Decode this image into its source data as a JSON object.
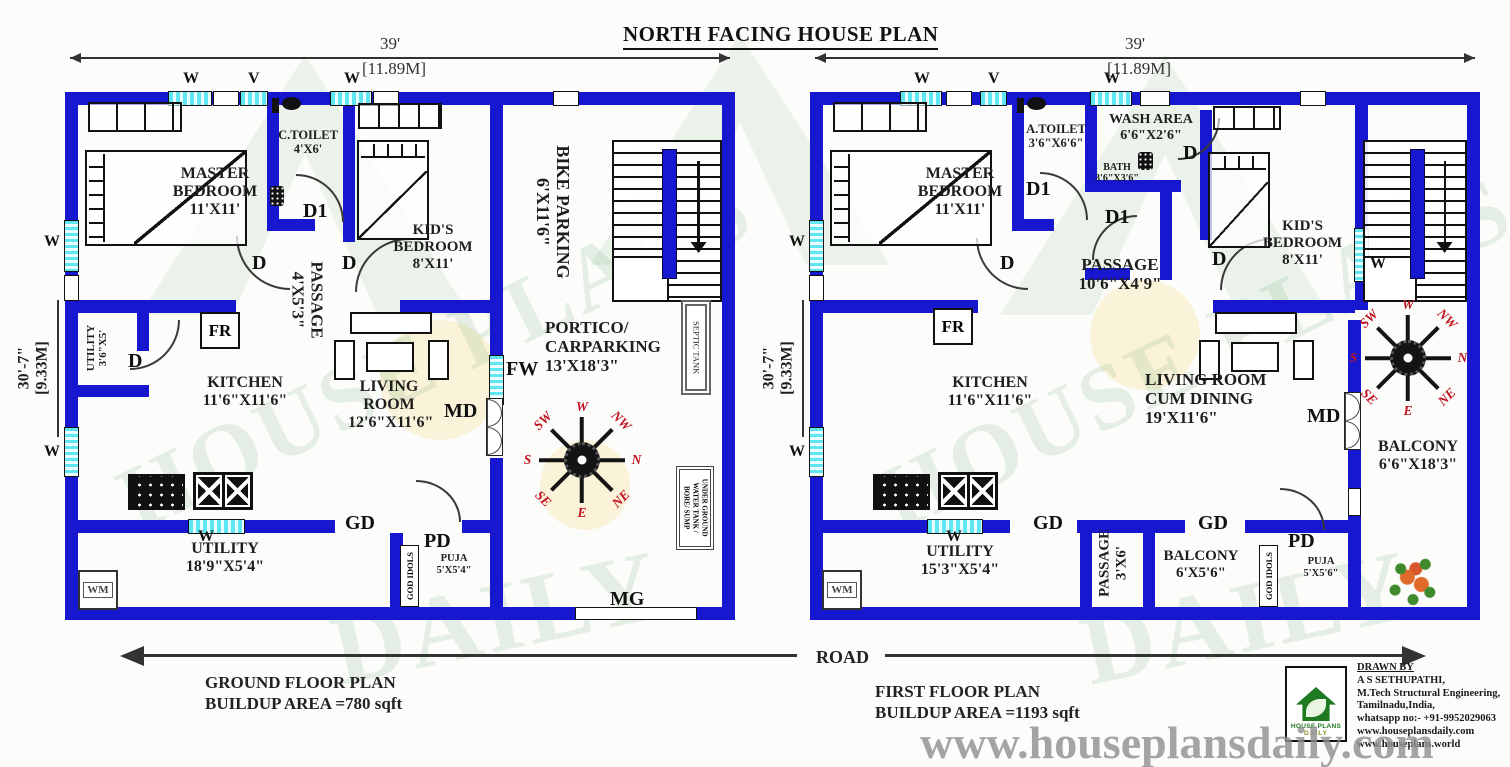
{
  "title": "NORTH FACING HOUSE PLAN",
  "dims": {
    "w_ft": "39'",
    "w_m": "[11.89M]",
    "h_ft": "30'-7\"",
    "h_m": "[9.33M]"
  },
  "tags": {
    "d": "D",
    "d1": "D1",
    "w": "W",
    "v": "V",
    "fr": "FR",
    "wm": "WM",
    "md": "MD",
    "gd": "GD",
    "pd": "PD",
    "fw": "FW",
    "mg": "MG"
  },
  "compass": {
    "n": "N",
    "ne": "NE",
    "e": "E",
    "se": "SE",
    "s": "S",
    "sw": "SW",
    "w": "W",
    "nw": "NW"
  },
  "ground": {
    "plan_name": "GROUND FLOOR PLAN",
    "area": "BUILDUP AREA =780 sqft",
    "master": {
      "name": "MASTER BEDROOM",
      "size": "11'X11'"
    },
    "ctoilet": {
      "name": "C.TOILET",
      "size": "4'X6'"
    },
    "passage": {
      "name": "PASSAGE",
      "size": "4'X5'3\""
    },
    "kids": {
      "name": "KID'S BEDROOM",
      "size": "8'X11'"
    },
    "bike": {
      "name": "BIKE PARKING",
      "size": "6'X11'6\""
    },
    "portico": {
      "name": "PORTICO/",
      "name2": "CARPARKING",
      "size": "13'X18'3\""
    },
    "kitchen": {
      "name": "KITCHEN",
      "size": "11'6\"X11'6\""
    },
    "utility_nook": {
      "name": "UTILITY",
      "size": "3'6\"X5'"
    },
    "living": {
      "name": "LIVING ROOM",
      "size": "12'6\"X11'6\""
    },
    "utility": {
      "name": "UTILITY",
      "size": "18'9\"X5'4\""
    },
    "puja": {
      "name": "PUJA",
      "size": "5'X5'4\""
    },
    "god_idols": "GOD IDOLS",
    "septic": "SEPTIC TANK",
    "ug1": "UNDER GROUND",
    "ug2": "WATER TANK /",
    "ug3": "BORE/ SUMP"
  },
  "first": {
    "plan_name": "FIRST FLOOR PLAN",
    "area": "BUILDUP AREA =1193 sqft",
    "master": {
      "name": "MASTER BEDROOM",
      "size": "11'X11'"
    },
    "atoilet": {
      "name": "A.TOILET",
      "size": "3'6\"X6'6\""
    },
    "wash": {
      "name": "WASH AREA",
      "size": "6'6\"X2'6\""
    },
    "bath": {
      "name": "BATH",
      "size": "3'6\"X3'6\""
    },
    "passage": {
      "name": "PASSAGE",
      "size": "10'6\"X4'9\""
    },
    "kids": {
      "name": "KID'S BEDROOM",
      "size": "8'X11'"
    },
    "kitchen": {
      "name": "KITCHEN",
      "size": "11'6\"X11'6\""
    },
    "living": {
      "name": "LIVING ROOM",
      "name2": "CUM DINING",
      "size": "19'X11'6\""
    },
    "balcony": {
      "name": "BALCONY",
      "size": "6'6\"X18'3\""
    },
    "utility": {
      "name": "UTILITY",
      "size": "15'3\"X5'4\""
    },
    "passage2": {
      "name": "PASSAGE",
      "size": "3'X6'"
    },
    "balcony2": {
      "name": "BALCONY",
      "size": "6'X5'6\""
    },
    "puja": {
      "name": "PUJA",
      "size": "5'X5'6\""
    },
    "god_idols": "GOD IDOLS"
  },
  "road": "ROAD",
  "credits": {
    "drawn_by": "DRAWN BY",
    "name": "A S SETHUPATHI,",
    "line2": "M.Tech Structural Engineering,",
    "line3": "Tamilnadu,India,",
    "line4": "whatsapp no:- +91-9952029063",
    "line5": "www.houseplansdaily.com",
    "line6": "www.houseplans.world"
  },
  "logo": {
    "line1": "HOUSE PLANS",
    "line2": "DAILY"
  },
  "watermark_url": "www.houseplansdaily.com",
  "watermark_text1": "HOUSE PLANS",
  "watermark_text2": "DAILY",
  "colors": {
    "wall": "#1717d0",
    "window": "#5fe6f0",
    "compass_text": "#c21420",
    "logo_green": "#1f7a22"
  }
}
